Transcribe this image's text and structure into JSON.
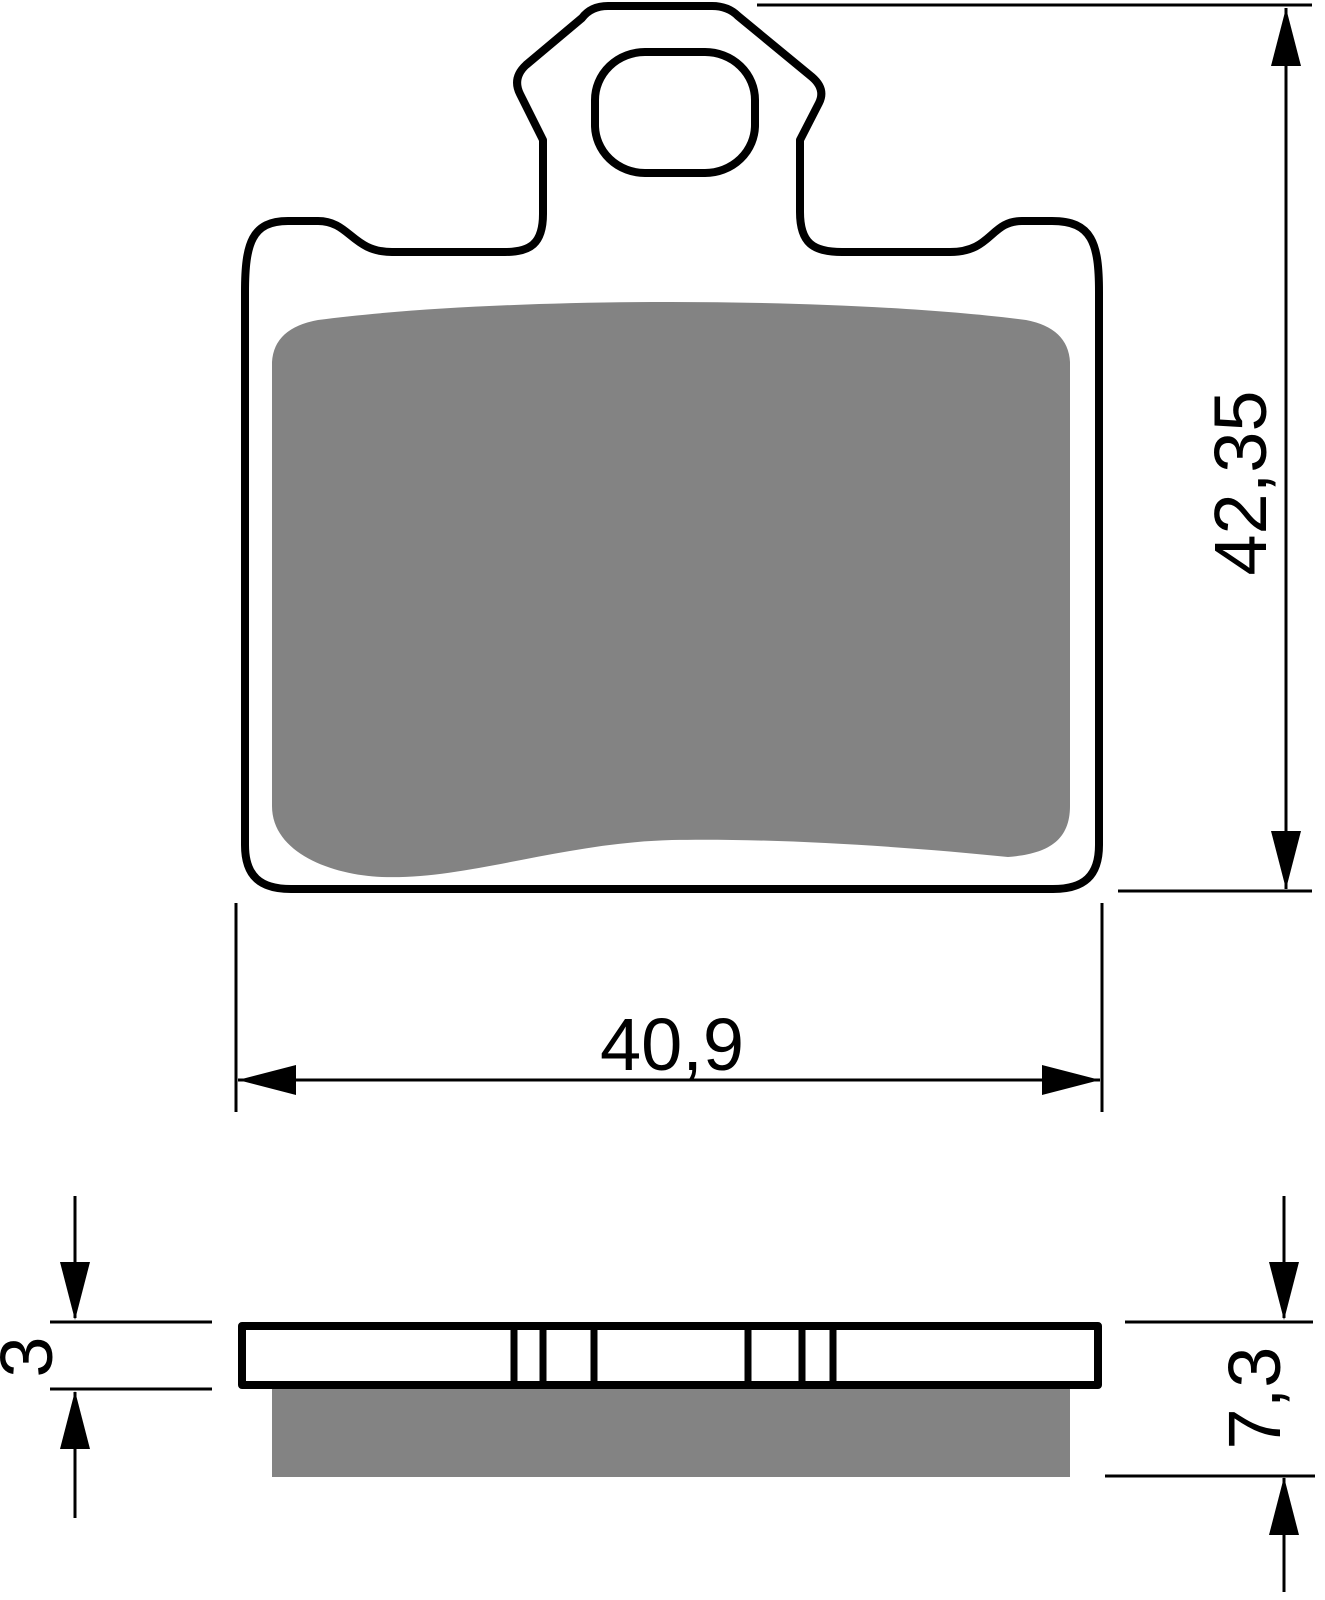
{
  "drawing": {
    "type": "technical-drawing-brake-pad",
    "views": {
      "front_view": "pad outline with mounting tab and oval hole, friction area shaded",
      "side_view": "backing plate with friction material layer shaded"
    }
  },
  "dims": {
    "height": "42,35",
    "width": "40,9",
    "plate": "3",
    "total": "7,3"
  },
  "colors": {
    "outline": "#000000",
    "friction": "#838383",
    "background": "#ffffff"
  }
}
